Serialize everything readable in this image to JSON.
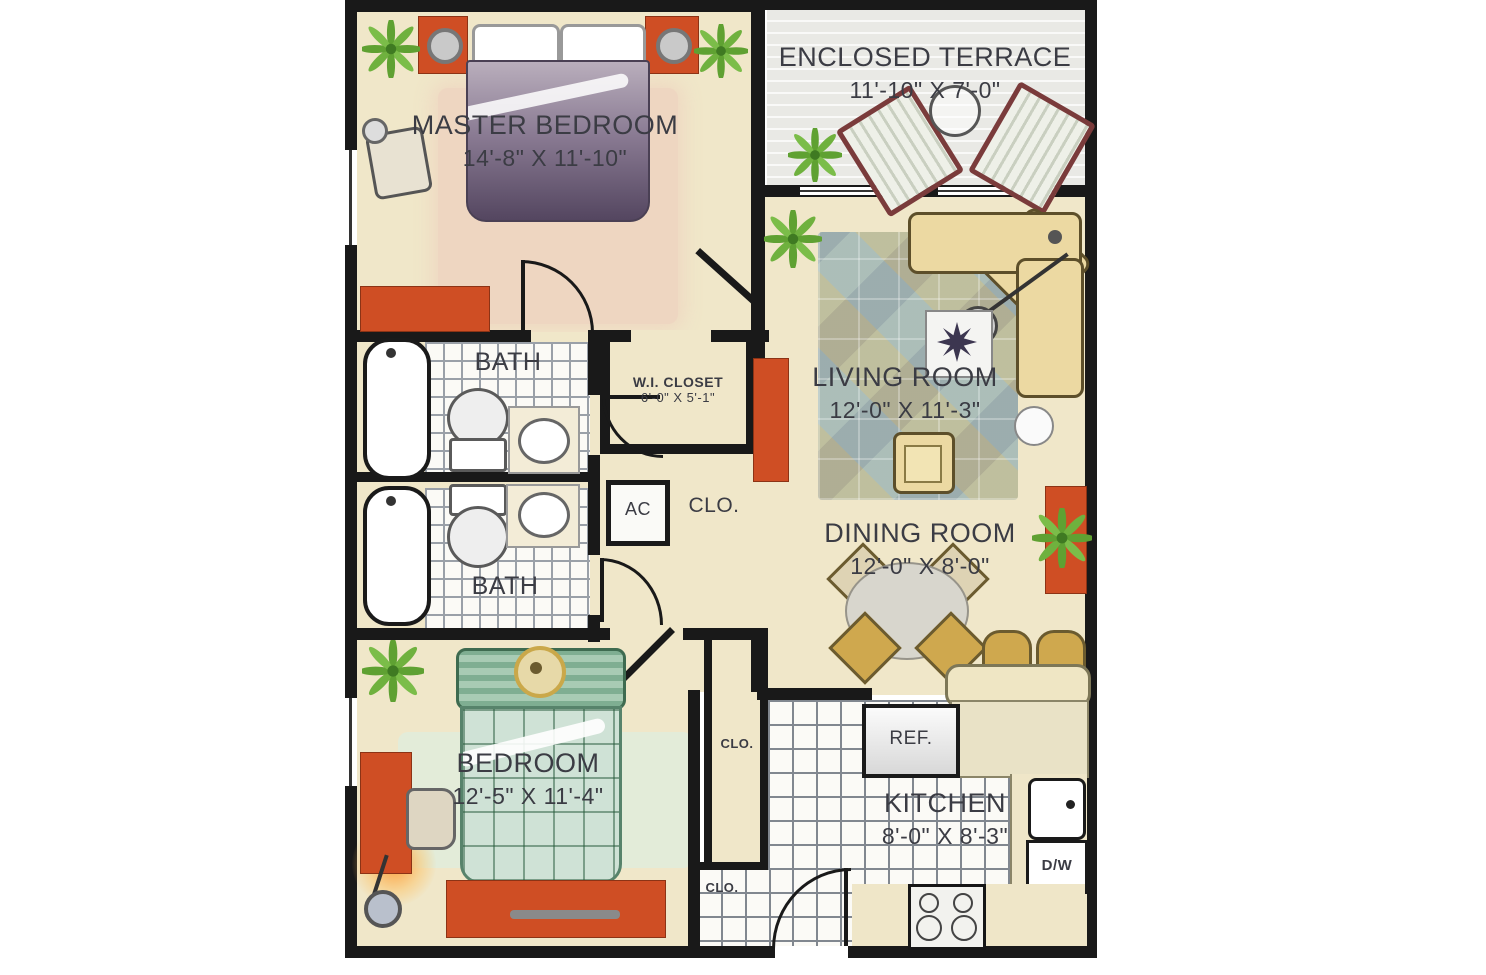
{
  "rooms": {
    "master_bedroom": {
      "label": "MASTER BEDROOM",
      "dims": "14'-8\" X 11'-10\""
    },
    "enclosed_terrace": {
      "label": "ENCLOSED TERRACE",
      "dims": "11'-10\" X 7'-0\""
    },
    "living_room": {
      "label": "LIVING ROOM",
      "dims": "12'-0\" X 11'-3\""
    },
    "dining_room": {
      "label": "DINING ROOM",
      "dims": "12'-0\" X 8'-0\""
    },
    "bedroom": {
      "label": "BEDROOM",
      "dims": "12'-5\" X 11'-4\""
    },
    "kitchen": {
      "label": "KITCHEN",
      "dims": "8'-0\" X 8'-3\""
    },
    "wi_closet": {
      "label": "W.I. CLOSET",
      "dims": "6'-0\" X 5'-1\""
    },
    "bath_upper": {
      "label": "BATH"
    },
    "bath_lower": {
      "label": "BATH"
    },
    "ac_closet": {
      "label": "AC"
    },
    "hall_closet": {
      "label": "CLO."
    },
    "bedroom_closet": {
      "label": "CLO."
    },
    "entry_closet": {
      "label": "CLO."
    }
  },
  "appliances": {
    "refrigerator": "REF.",
    "dishwasher": "D/W"
  },
  "colors": {
    "wall": "#191919",
    "floor": "#f0e7c9",
    "accent_orange": "#cf4e24",
    "rug_blue": "#a9c7c5",
    "bed_purple": "#544660",
    "bed_green": "#cfe2d6",
    "terrace_gray": "#e9e9e5"
  }
}
